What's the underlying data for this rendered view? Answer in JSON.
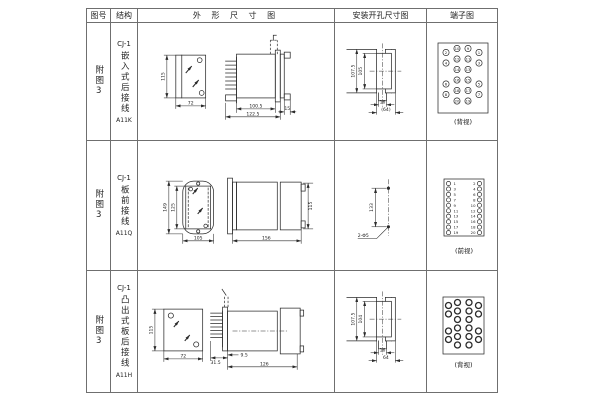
{
  "header": {
    "figure": "图号",
    "structure": "结构",
    "outline": "外 形 尺 寸 图",
    "mounting": "安装开孔尺寸图",
    "terminal": "端子图"
  },
  "rows": [
    {
      "figure": "附图3",
      "model": "CJ-1",
      "desc": "嵌入式后接线",
      "code": "A11K",
      "dims": {
        "h": "115",
        "w": "72",
        "body": "100.5",
        "total": "122.5",
        "flange": "15"
      },
      "mount": {
        "outer": "107.5",
        "inner": "105",
        "stub": "16",
        "width": "(64)"
      },
      "view": "(背视)"
    },
    {
      "figure": "附图3",
      "model": "CJ-1",
      "desc": "板前接线",
      "code": "A11Q",
      "dims": {
        "outer_h": "149",
        "inner_h": "125",
        "w": "105",
        "len": "156",
        "h": "115"
      },
      "mount": {
        "spacing": "133",
        "holes": "2-Φ5"
      },
      "view": "(前视)"
    },
    {
      "figure": "附图3",
      "model": "CJ-1",
      "desc": "凸出式板后接线",
      "code": "A11H",
      "dims": {
        "h": "115",
        "w": "72",
        "pin": "31.5",
        "offset": "9.5",
        "len": "126"
      },
      "mount": {
        "outer": "107.5",
        "inner": "104",
        "stub": "16",
        "width": "64"
      },
      "view": "(背视)"
    }
  ],
  "terminals": {
    "r1": [
      "2",
      "10",
      "9",
      "1",
      "4",
      "12",
      "11",
      "3",
      "14",
      "13",
      "6",
      "16",
      "15",
      "5",
      "8",
      "18",
      "17",
      "7",
      "20",
      "19"
    ],
    "r2_left": [
      "1",
      "3",
      "5",
      "7",
      "9",
      "11",
      "13",
      "15",
      "17",
      "19"
    ],
    "r2_right": [
      "2",
      "4",
      "6",
      "8",
      "10",
      "12",
      "14",
      "16",
      "18",
      "20"
    ]
  },
  "colors": {
    "line": "#2b2b2b",
    "border": "#6f6f6f",
    "background": "#ffffff"
  }
}
